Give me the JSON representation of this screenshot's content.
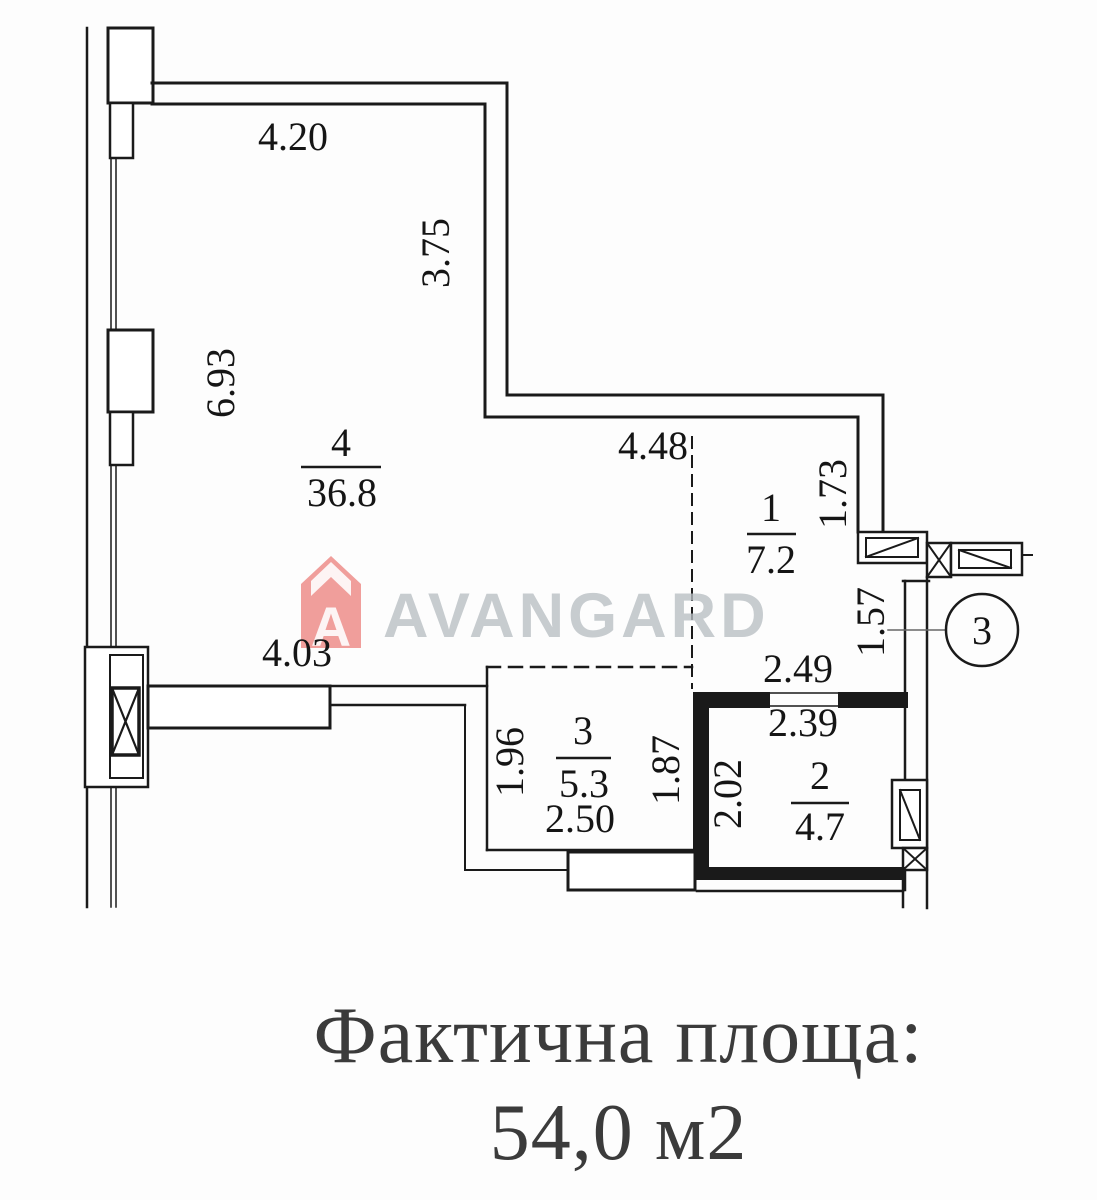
{
  "plan": {
    "rooms": [
      {
        "number": "4",
        "area": "36.8"
      },
      {
        "number": "1",
        "area": "7.2"
      },
      {
        "number": "3",
        "area": "5.3"
      },
      {
        "number": "2",
        "area": "4.7"
      }
    ],
    "dimensions": {
      "d420": "4.20",
      "d375": "3.75",
      "d693": "6.93",
      "d448": "4.48",
      "d173": "1.73",
      "d403": "4.03",
      "d157": "1.57",
      "d249": "2.49",
      "d239": "2.39",
      "d202": "2.02",
      "d196": "1.96",
      "d187": "1.87",
      "d250": "2.50"
    },
    "callout_label": "3"
  },
  "watermark": {
    "brand": "AVANGARD",
    "icon_letter": "A",
    "brand_color": "#b8bec3",
    "icon_color": "#ee8e8b"
  },
  "caption": {
    "line1": "Фактична площа:",
    "line2": "54,0 м2",
    "color": "#3b3b3b"
  }
}
